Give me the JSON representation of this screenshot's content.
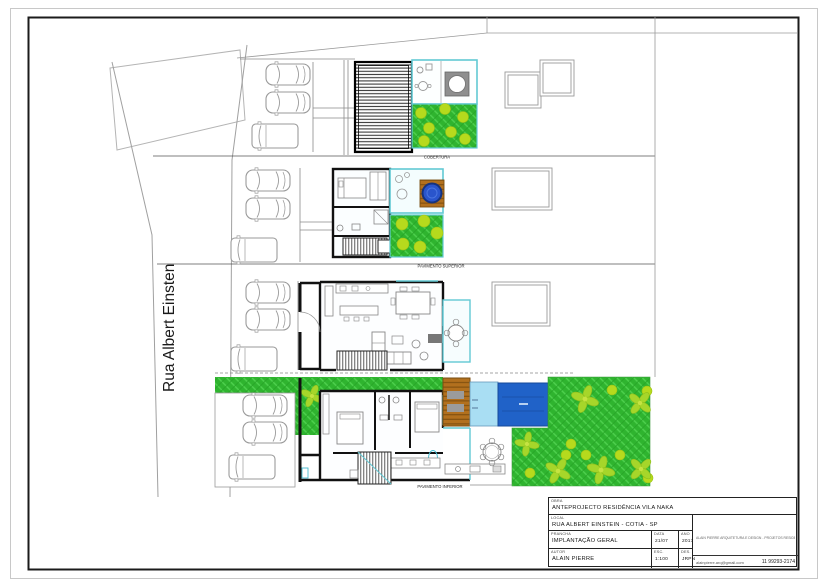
{
  "sheet": {
    "street_label": "Rua Albert Einsten",
    "labels": {
      "roof": "COBERTURA",
      "upper": "PAVIMENTO SUPERIOR",
      "lower": "PAVIMENTO INFERIOR"
    },
    "title_block": {
      "project_label": "OBRA",
      "project": "ANTEPROJECTO RESIDÊNCIA VILA NAKA",
      "address_label": "LOCAL",
      "address": "RUA ALBERT EINSTEIN - COTIA - SP",
      "sheet_label": "PRANCHA",
      "sheet_title": "IMPLANTAÇÃO GERAL",
      "date_label": "DATA",
      "date": "21/07",
      "year_label": "ANO",
      "year": "2017",
      "author_label": "AUTOR",
      "author": "ALAIN PIERRE",
      "scale_label": "ESC.",
      "scale": "1:100",
      "drafter_label": "DES.",
      "drafter": "JRPN",
      "office_line": "ALAIN PIERRE ARQUITETURA E DESIGN - PROJETOS RESIDENCIAIS",
      "email": "alainpierre.arq@gmail.com",
      "phone": "11 99293-2174"
    },
    "colors": {
      "garden_green": "#2fb42f",
      "garden_hatch_light": "#4fd14f",
      "garden_hatch_dark": "#27a427",
      "tree_green": "#a6d62a",
      "bush_green": "#b6da1d",
      "teal_accent": "#62c9d4",
      "pool_dark": "#2062c8",
      "pool_light": "#a9def3",
      "deck_brown": "#b2701e",
      "jacuzzi_blue": "#2a55cc",
      "wall_black": "#111111",
      "line_gray": "#9a9a9a"
    }
  }
}
